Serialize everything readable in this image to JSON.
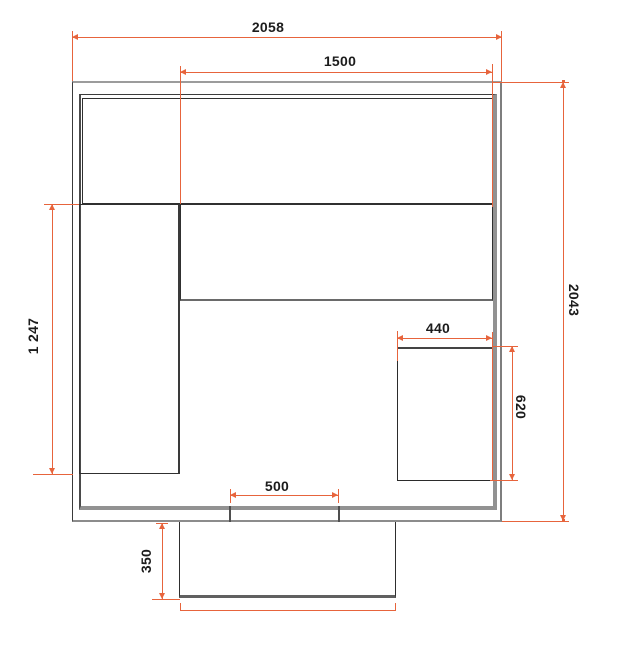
{
  "drawing": {
    "type": "floor-plan-with-dimensions",
    "units": "mm",
    "colors": {
      "dimension_red": "#e7643c",
      "outline_dark": "#2f2f2f",
      "outline_gray": "#8f8f8f",
      "background": "#ffffff"
    },
    "dims": {
      "d2058": {
        "label": "2058"
      },
      "d1500": {
        "label": "1500"
      },
      "d2043": {
        "label": "2043"
      },
      "d1247": {
        "label": "1 247"
      },
      "d440": {
        "label": "440"
      },
      "d620": {
        "label": "620"
      },
      "d500": {
        "label": "500"
      },
      "d350": {
        "label": "350"
      }
    }
  }
}
